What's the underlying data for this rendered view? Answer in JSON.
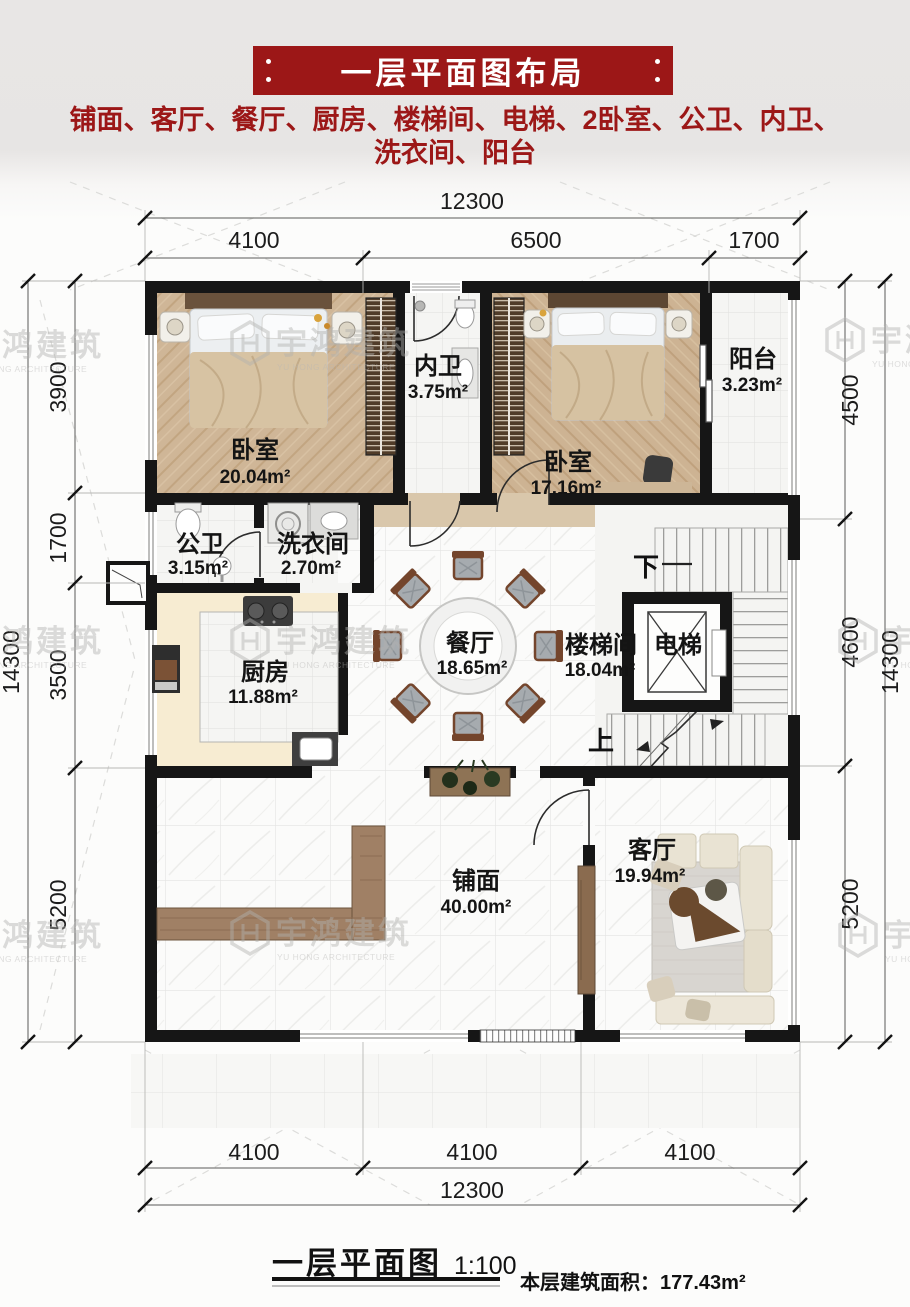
{
  "header": {
    "title": "一层平面图布局",
    "subtitle_line1": "铺面、客厅、餐厅、厨房、楼梯间、电梯、2卧室、公卫、内卫、",
    "subtitle_line2": "洗衣间、阳台",
    "accent_color": "#9c1717"
  },
  "watermark": {
    "brand": "宇鸿建筑",
    "brand_en": "YU HONG ARCHITECTURE"
  },
  "dimensions": {
    "top_total": "12300",
    "top_segments": [
      "4100",
      "6500",
      "1700"
    ],
    "bottom_segments": [
      "4100",
      "4100",
      "4100"
    ],
    "bottom_total": "12300",
    "left_total": "14300",
    "left_segments": [
      "3900",
      "1700",
      "3500",
      "5200"
    ],
    "right_total": "14300",
    "right_segments": [
      "4500",
      "4600",
      "5200"
    ]
  },
  "rooms": [
    {
      "name": "卧室",
      "area": "20.04m²"
    },
    {
      "name": "内卫",
      "area": "3.75m²"
    },
    {
      "name": "卧室",
      "area": "17.16m²"
    },
    {
      "name": "阳台",
      "area": "3.23m²"
    },
    {
      "name": "公卫",
      "area": "3.15m²"
    },
    {
      "name": "洗衣间",
      "area": "2.70m²"
    },
    {
      "name": "厨房",
      "area": "11.88m²"
    },
    {
      "name": "餐厅",
      "area": "18.65m²"
    },
    {
      "name": "楼梯间",
      "area": "18.04m²"
    },
    {
      "name": "电梯",
      "area": ""
    },
    {
      "name": "铺面",
      "area": "40.00m²"
    },
    {
      "name": "客厅",
      "area": "19.94m²"
    }
  ],
  "stairs": {
    "down": "下",
    "up": "上"
  },
  "footer": {
    "plan_name": "一层平面图",
    "scale": "1:100",
    "area_label": "本层建筑面积：",
    "area_value": "177.43m²"
  }
}
